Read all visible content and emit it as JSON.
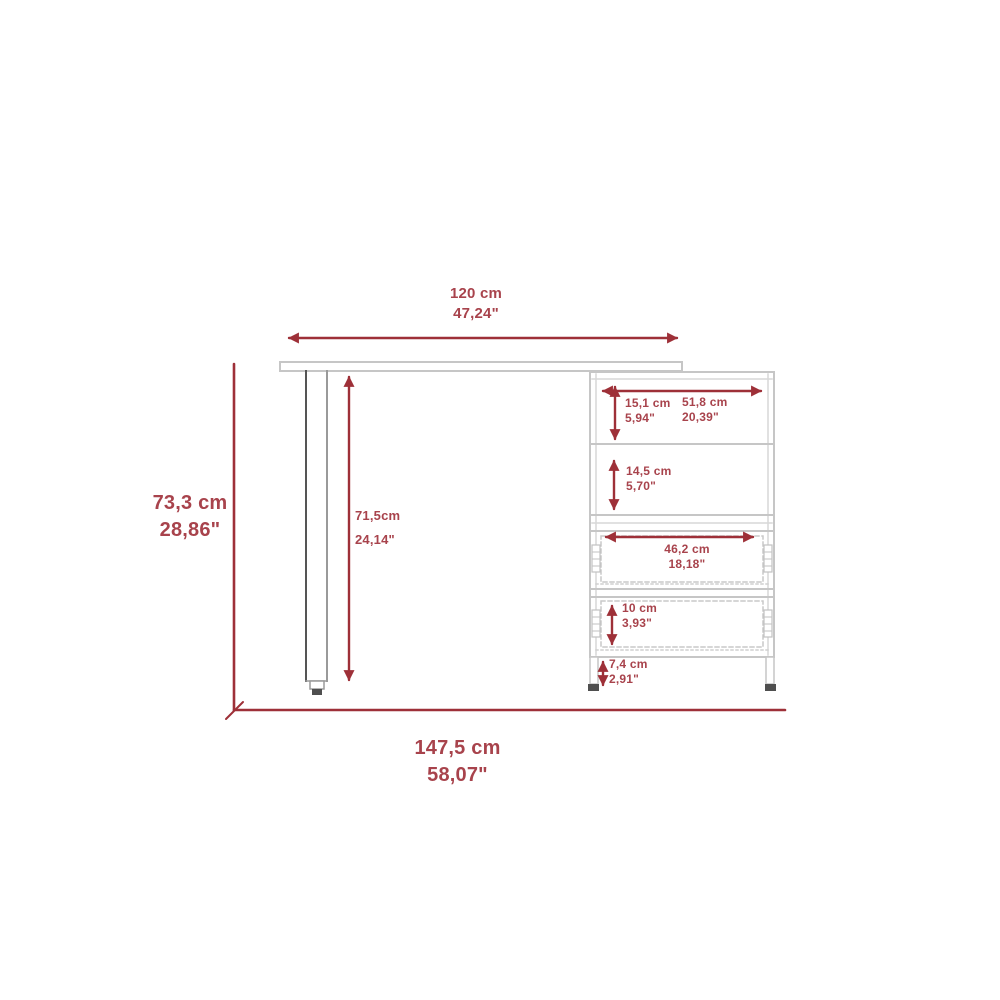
{
  "diagram": {
    "kind": "furniture-dimension-drawing",
    "subject": "l-shaped-desk-with-shelf-and-drawer-cabinet",
    "colors": {
      "dimension_red": "#9e3038",
      "label_red": "#a8434c",
      "outline_gray": "#c6c6c6",
      "outline_dark": "#4f4f4f"
    },
    "dimensions": {
      "desk_width": {
        "cm": "120 cm",
        "inches": "47,24\""
      },
      "total_height": {
        "cm": "73,3 cm",
        "inches": "28,86\""
      },
      "total_width": {
        "cm": "147,5 cm",
        "inches": "58,07\""
      },
      "leg_height": {
        "cm": "71,5cm",
        "inches": "24,14\""
      },
      "shelf1_height": {
        "cm": "15,1 cm",
        "inches": "5,94\""
      },
      "shelf_width": {
        "cm": "51,8 cm",
        "inches": "20,39\""
      },
      "shelf2_height": {
        "cm": "14,5 cm",
        "inches": "5,70\""
      },
      "drawer_width": {
        "cm": "46,2 cm",
        "inches": "18,18\""
      },
      "drawer_height": {
        "cm": "10 cm",
        "inches": "3,93\""
      },
      "foot_height": {
        "cm": "7,4 cm",
        "inches": "2,91\""
      }
    }
  }
}
